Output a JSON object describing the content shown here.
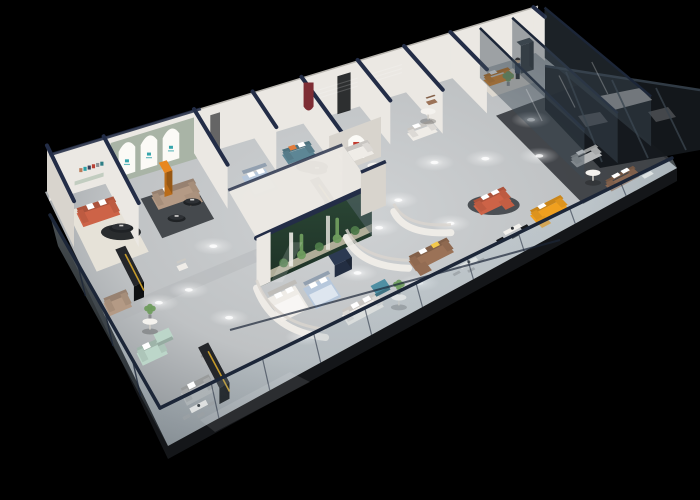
{
  "canvas": {
    "width": 700,
    "height": 500,
    "background": "#000000"
  },
  "scene_label": "isometric-3d-furniture-showroom-cutaway-render",
  "palette": {
    "bg": "#000000",
    "floor": "#c3c6c8",
    "floorHi": "#d2d5d6",
    "floorLo": "#858b90",
    "floorDark": "#35393d",
    "slab": "#141619",
    "wall": "#ebe8e3",
    "wallShade": "#d8d4cd",
    "wallDark": "#c2beb7",
    "cap": "#232d47",
    "rail": "#1c2638",
    "glass": "#a9bcc8",
    "glassDark": "#3e4c57",
    "sage": "#a9b4a6",
    "sageLedge": "#c2cdc0",
    "arch": "#fbfaf6",
    "archLogo": "#2aa0a8",
    "cream": "#e6e2d8",
    "rugDark": "#45494d",
    "rugBlack": "#1f2225",
    "rugLight": "#d7d6d2",
    "rugBeige": "#ddd8cf",
    "coral": "#cd6347",
    "orange": "#e8871f",
    "yellowSofa": "#f0a01f",
    "burgundy": "#7e2d34",
    "redLogo": "#c23a2e",
    "gold": "#c59a2a",
    "teal": "#5d8695",
    "tealBlue": "#4f8fa3",
    "mint": "#bcd6c9",
    "blueBed": "#b7c8dc",
    "taupe": "#b49a85",
    "brown": "#9b7257",
    "leather": "#8a6751",
    "graySofa": "#b6b8b9",
    "white": "#efece7",
    "black": "#121417",
    "navyFurn": "#2c3a52",
    "boardDark": "#3a4046",
    "green1": "#4e7a4a",
    "green2": "#6f9c5e",
    "terraTop": "#2c4836",
    "terraBot": "#1c2f25",
    "sand": "#c9c2ac",
    "skin": "#d9b38c"
  },
  "gallery_frame_colors": [
    "#b97b5a",
    "#2aa0a8",
    "#39425a",
    "#b94135",
    "#8d9296",
    "#2f7f86"
  ],
  "arch_windows": {
    "count": 3,
    "logo_color": "#2aa0a8"
  },
  "objects": [
    {
      "id": "rug-west",
      "label": "cream area rug",
      "color": "cream"
    },
    {
      "id": "sofa-coral-west",
      "label": "coral fabric sofa with white pillows",
      "color": "coral"
    },
    {
      "id": "round-rug-west",
      "label": "black round rug",
      "color": "rugBlack"
    },
    {
      "id": "table-west",
      "label": "black oval coffee table",
      "color": "rugBlack"
    },
    {
      "id": "counter-left",
      "label": "black display counter with gold trim",
      "color": "black"
    },
    {
      "id": "taupe-sofa-west",
      "label": "taupe loveseat",
      "color": "taupe"
    },
    {
      "id": "rug-arches",
      "label": "charcoal area rug",
      "color": "rugDark"
    },
    {
      "id": "sofa-taupe",
      "label": "taupe sectional sofa",
      "color": "taupe"
    },
    {
      "id": "table-arch-1",
      "label": "black coffee table",
      "color": "rugBlack"
    },
    {
      "id": "table-arch-2",
      "label": "black coffee table",
      "color": "rugBlack"
    },
    {
      "id": "cabinet-orange",
      "label": "orange display cabinet",
      "color": "orange"
    },
    {
      "id": "bed-blue-left",
      "label": "light blue bed",
      "color": "blueBed"
    },
    {
      "id": "sofa-teal",
      "label": "teal sofa with orange pillow",
      "color": "teal"
    },
    {
      "id": "round-rug-teal",
      "label": "black round rug",
      "color": "rugBlack"
    },
    {
      "id": "table-teal",
      "label": "black oval coffee table",
      "color": "rugBlack"
    },
    {
      "id": "sofa-white-mid",
      "label": "white corner sofa",
      "color": "white"
    },
    {
      "id": "table-white-mid",
      "label": "round side table",
      "color": "white"
    },
    {
      "id": "counter-mid",
      "label": "black display counter with gold trim",
      "color": "black"
    },
    {
      "id": "dining-mid",
      "label": "white dining set",
      "color": "white"
    },
    {
      "id": "sofa-white-top",
      "label": "white sofa set",
      "color": "white"
    },
    {
      "id": "chair-brown-top",
      "label": "brown armchair",
      "color": "brown"
    },
    {
      "id": "table-round-top",
      "label": "round side table",
      "color": "white"
    },
    {
      "id": "sofa-brown-center",
      "label": "brown leather sectional",
      "color": "brown"
    },
    {
      "id": "dining-center",
      "label": "dining table set",
      "color": "white"
    },
    {
      "id": "bed-white-pod",
      "label": "white bed in curved pod",
      "color": "white"
    },
    {
      "id": "bed-blue-pod",
      "label": "blue bed in curved pod",
      "color": "blueBed"
    },
    {
      "id": "cabinet-navy",
      "label": "navy media cabinet",
      "color": "navyFurn"
    },
    {
      "id": "sofa-white-front",
      "label": "white long sofa",
      "color": "white"
    },
    {
      "id": "ottoman-teal",
      "label": "teal ottoman cube",
      "color": "tealBlue"
    },
    {
      "id": "table-front",
      "label": "round coffee table with plant",
      "color": "white"
    },
    {
      "id": "sofa-mint",
      "label": "mint green sofa",
      "color": "mint"
    },
    {
      "id": "ottoman-mint",
      "label": "mint chaise",
      "color": "mint"
    },
    {
      "id": "table-mint",
      "label": "round coffee table with plant",
      "color": "white"
    },
    {
      "id": "sofa-gray-front",
      "label": "gray sofa",
      "color": "graySofa"
    },
    {
      "id": "chair-gray",
      "label": "gray armchair",
      "color": "graySofa"
    },
    {
      "id": "dining-left",
      "label": "dining table with chairs",
      "color": "white"
    },
    {
      "id": "counter-front",
      "label": "black display counter with gold trim",
      "color": "black"
    },
    {
      "id": "chair-white-lone",
      "label": "white lounge chair",
      "color": "white"
    },
    {
      "id": "round-rug-right",
      "label": "dark oval rug",
      "color": "rugDark"
    },
    {
      "id": "sofa-coral-right",
      "label": "coral sectional with white pillows",
      "color": "coral"
    },
    {
      "id": "sofa-yellow",
      "label": "yellow L-shaped sofa",
      "color": "yellowSofa"
    },
    {
      "id": "desk-right",
      "label": "white desk with chair",
      "color": "white"
    },
    {
      "id": "rug-tr",
      "label": "beige rug",
      "color": "rugBeige"
    },
    {
      "id": "sofa-orange-tr",
      "label": "orange sofa",
      "color": "orange"
    },
    {
      "id": "board-tr",
      "label": "dark display board",
      "color": "boardDark"
    },
    {
      "id": "person-tr",
      "label": "standing salesperson figure",
      "color": "navyFurn"
    },
    {
      "id": "plant-tr",
      "label": "potted plant",
      "color": "green2"
    },
    {
      "id": "sofa-gray-east",
      "label": "gray sofa",
      "color": "graySofa"
    },
    {
      "id": "sofa-brown-east",
      "label": "brown leather sofa with white pillows",
      "color": "leather"
    },
    {
      "id": "chair-white-east",
      "label": "white swivel chair",
      "color": "white"
    },
    {
      "id": "table-east",
      "label": "round coffee table",
      "color": "white"
    }
  ],
  "features": {
    "terrarium": {
      "label": "glass terrarium with cacti and greenery",
      "plant_colors": [
        "#4e7a4a",
        "#6f9c5e"
      ]
    },
    "curved_pods": {
      "label": "curved white bed partitions",
      "count": 2
    },
    "glass_walls": {
      "label": "perimeter glass curtain wall",
      "tint": "#a9bcc8"
    },
    "spotlights": {
      "label": "ceiling downlight glow spots",
      "count": 16
    }
  }
}
